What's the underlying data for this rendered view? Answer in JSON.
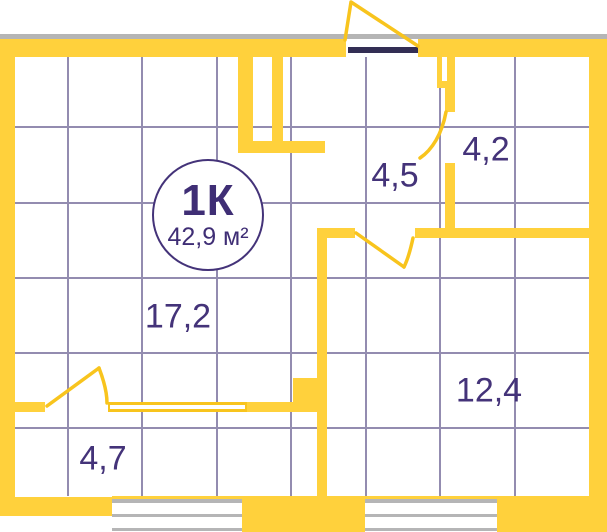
{
  "plan": {
    "badge": {
      "rooms_label": "1К",
      "total_area": "42,9 м²"
    },
    "room_areas": [
      {
        "id": "hallway",
        "area": "4,5"
      },
      {
        "id": "bathroom",
        "area": "4,2"
      },
      {
        "id": "living",
        "area": "17,2"
      },
      {
        "id": "bedroom",
        "area": "12,4"
      },
      {
        "id": "balcony",
        "area": "4,7"
      }
    ],
    "colors": {
      "wall_yellow": "#FFD13C",
      "thin_line_yellow": "#F8C41D",
      "accent_text_purple": "#443379",
      "grid_purple": "#938CB0",
      "facade_gray": "#B5B5B6",
      "entrance_door_dark": "#332E54"
    }
  }
}
